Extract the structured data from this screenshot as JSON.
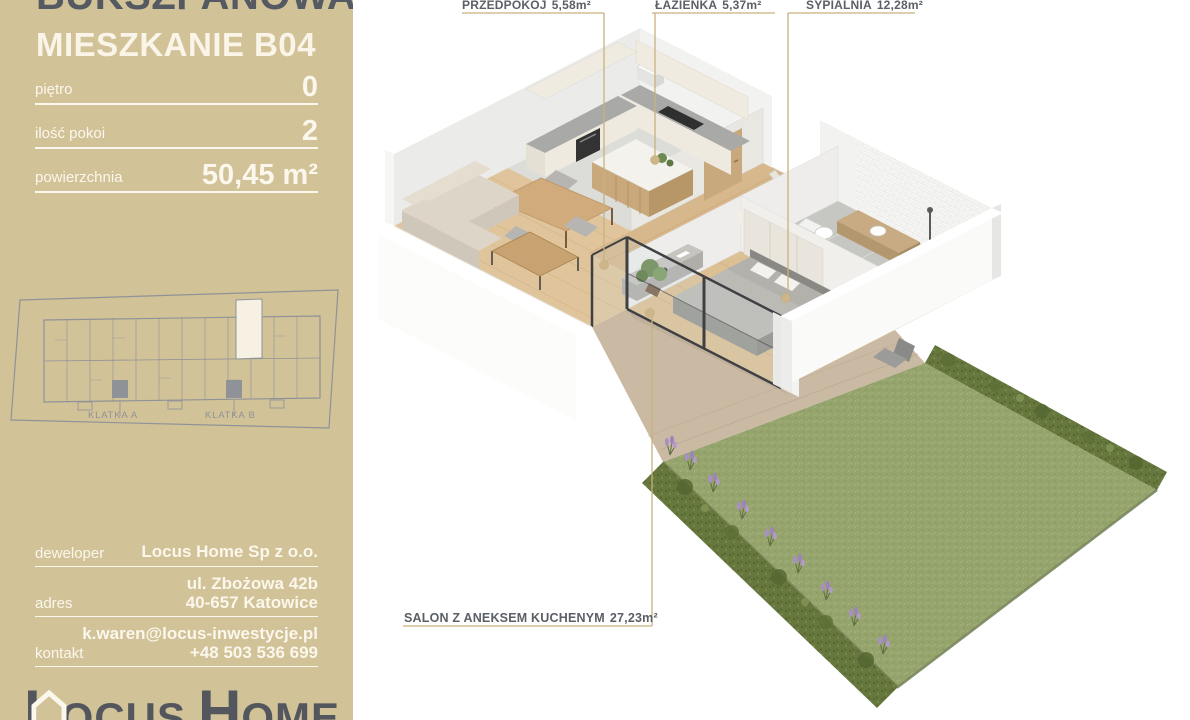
{
  "sidebar": {
    "project_name": "BUKSZPANOWA",
    "unit_label": "MIESZKANIE",
    "unit_number": "B04",
    "specs": [
      {
        "label": "piętro",
        "value": "0"
      },
      {
        "label": "ilość pokoi",
        "value": "2"
      },
      {
        "label": "powierzchnia",
        "value": "50,45 m²"
      }
    ],
    "building_map": {
      "klatka_a": "KLATKA A",
      "klatka_b": "KLATKA B"
    },
    "contact": {
      "developer_label": "deweloper",
      "developer": "Locus Home Sp z o.o.",
      "address_label": "adres",
      "address_line1": "ul. Zbożowa 42b",
      "address_line2": "40-657 Katowice",
      "contact_label": "kontakt",
      "email": "k.waren@locus-inwestycje.pl",
      "phone": "+48 503 536 699"
    },
    "logo": {
      "l1": "L",
      "l2": "OCUS",
      "l3": "H",
      "l4": "OME"
    }
  },
  "floorplan": {
    "rooms": [
      {
        "name": "przedpokoj",
        "label": "PRZEDPOKÓJ",
        "area": "5,58m²"
      },
      {
        "name": "lazienka",
        "label": "ŁAZIENKA",
        "area": "5,37m²"
      },
      {
        "name": "sypialnia",
        "label": "SYPIALNIA",
        "area": "12,28m²"
      },
      {
        "name": "salon",
        "label": "SALON Z ANEKSEM KUCHENYM",
        "area": "27,23m²"
      }
    ]
  },
  "colors": {
    "sidebar_bg": "#d2c298",
    "title_text": "#555a62",
    "light_text": "#fbf7ec",
    "leader_gold": "#c8b17f",
    "map_gray": "#8f9297",
    "grass": "#95a46d",
    "hedge": "#66783e",
    "lavender": "#a98fc4",
    "wood_floor": "#e0c59c",
    "wall_white": "#f2f2f0"
  }
}
